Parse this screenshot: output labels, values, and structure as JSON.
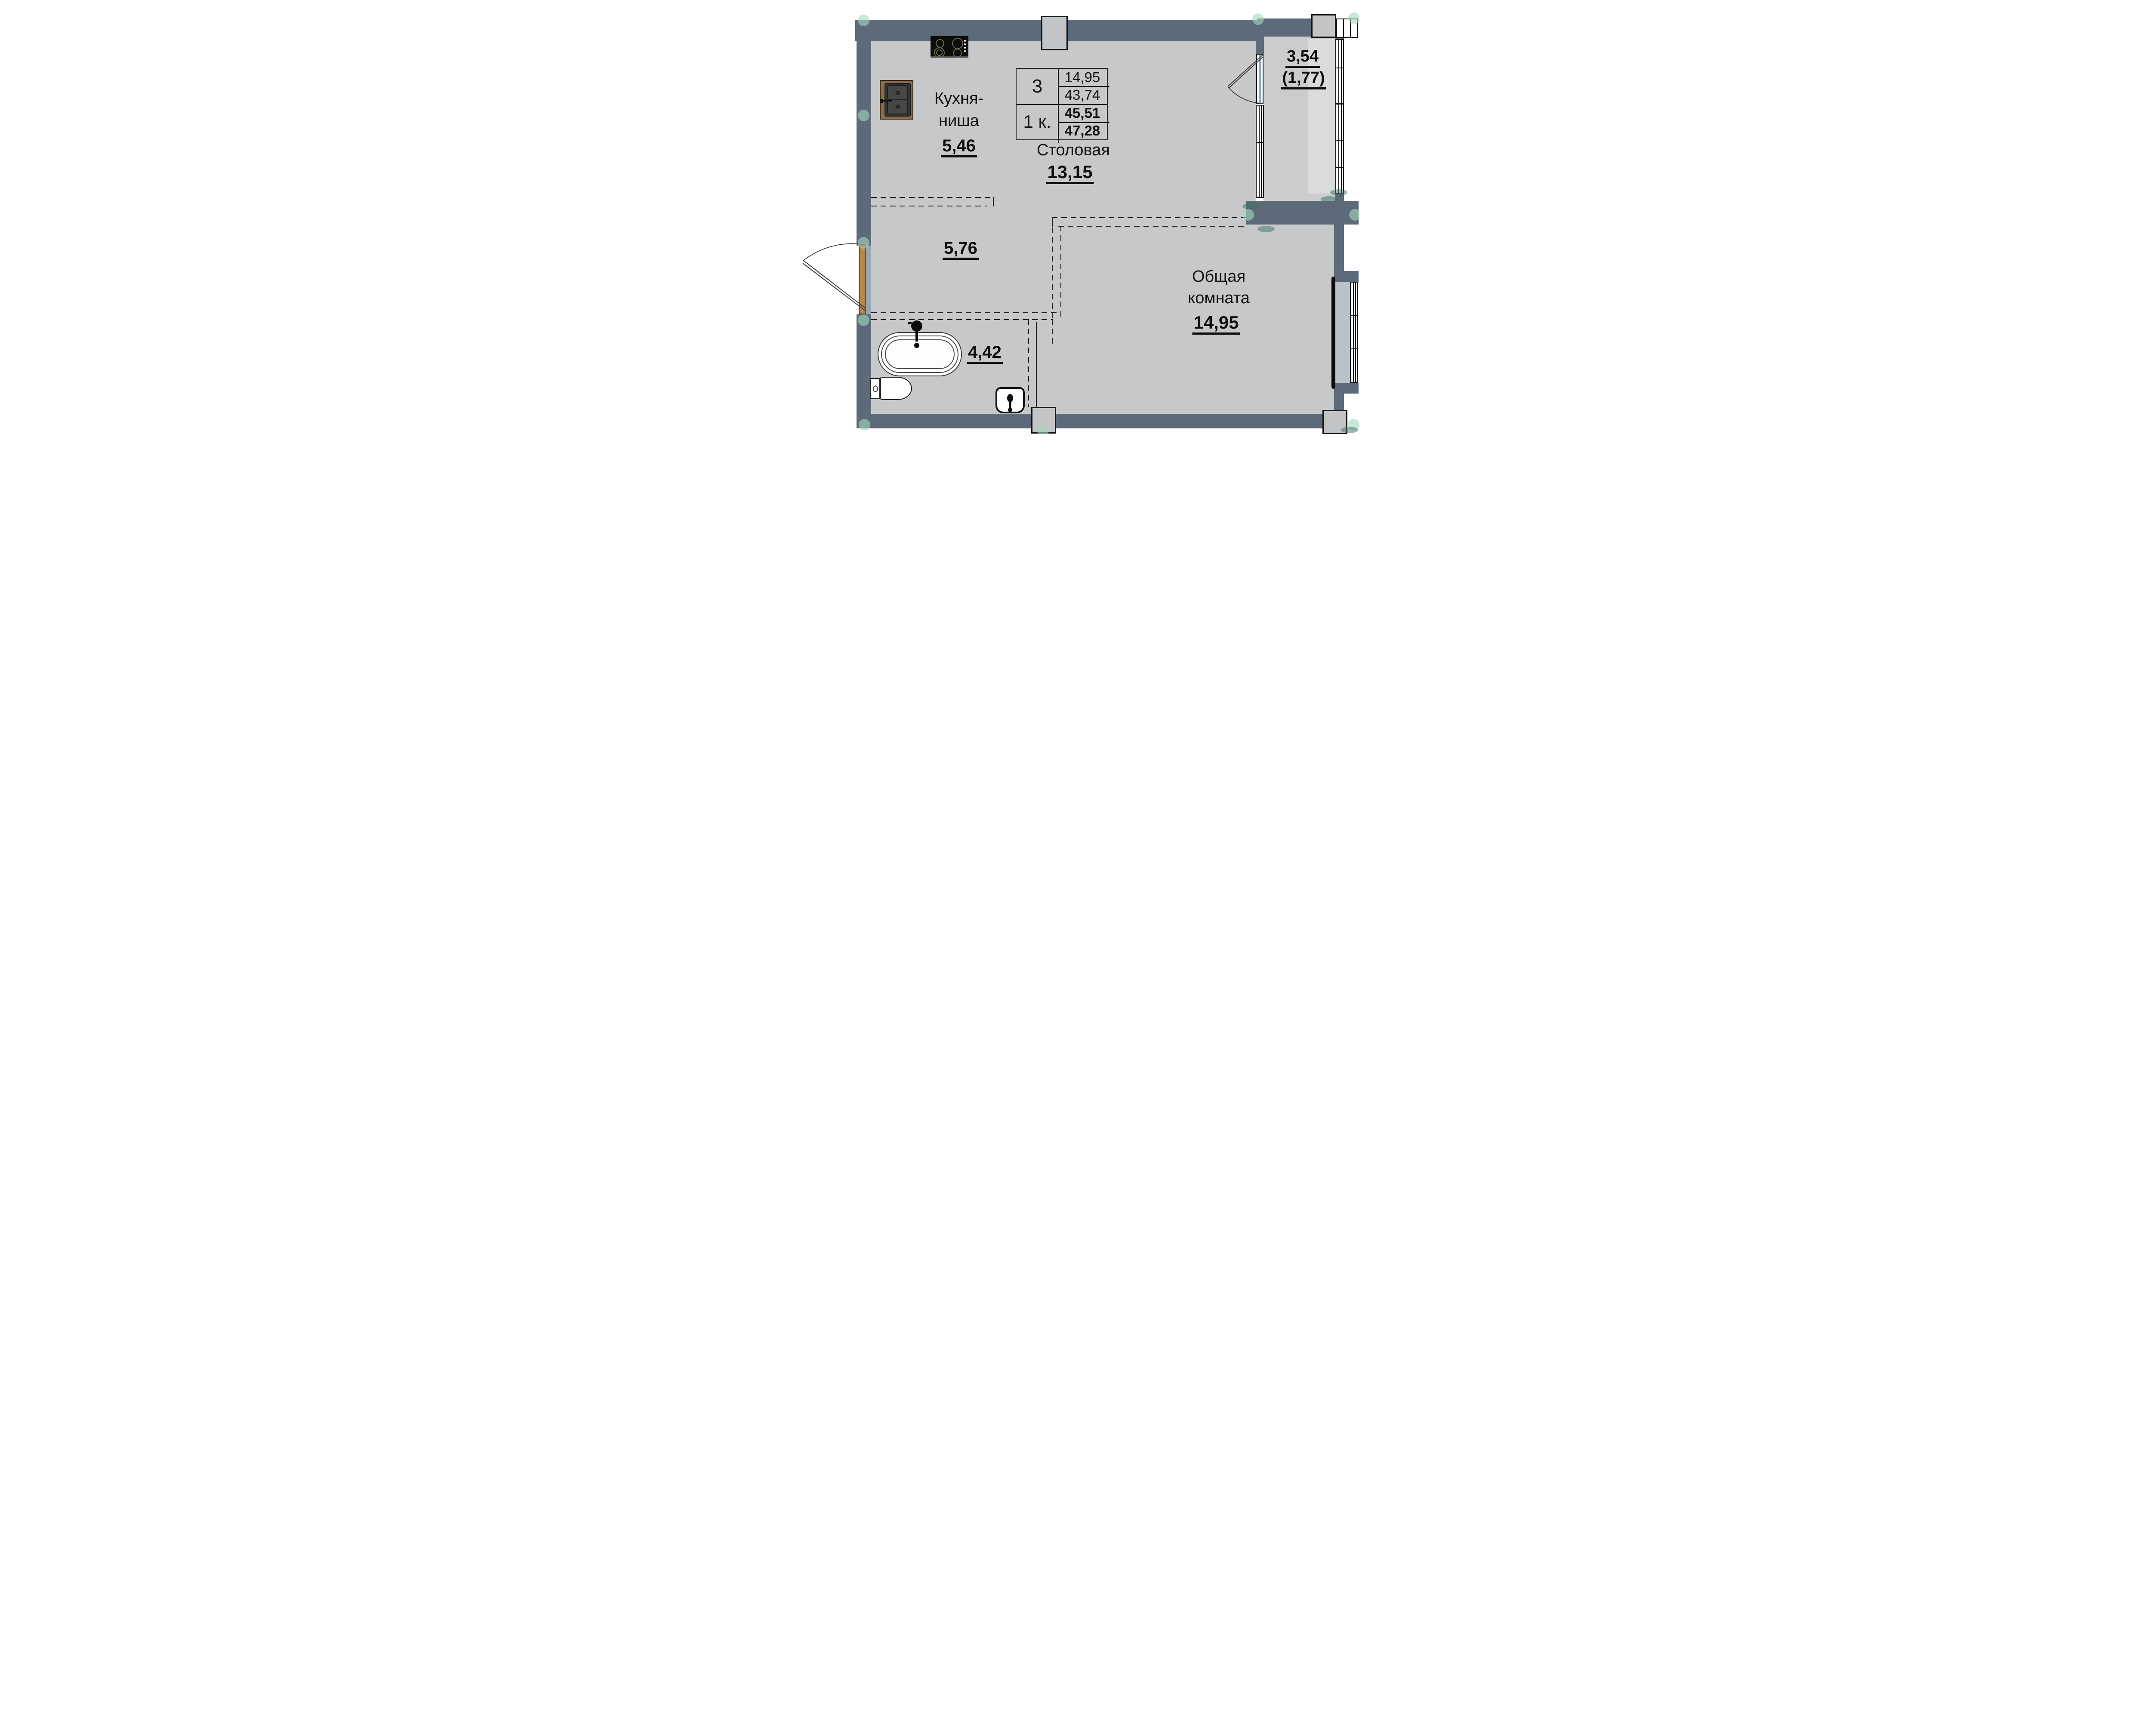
{
  "plan": {
    "stat_table": {
      "rooms_count": "3",
      "unit_type": "1 к.",
      "living_area": "14,95",
      "area_mid": "43,74",
      "area_no_balcony": "45,51",
      "area_total": "47,28"
    },
    "rooms": {
      "kitchen": {
        "label_line1": "Кухня-",
        "label_line2": "ниша",
        "area": "5,46"
      },
      "dining": {
        "label": "Столовая",
        "area": "13,15"
      },
      "living": {
        "label_line1": "Общая",
        "label_line2": "комната",
        "area": "14,95"
      },
      "hall": {
        "area": "5,76"
      },
      "bathroom": {
        "area": "4,42"
      },
      "balcony": {
        "area": "3,54",
        "area_reduced": "(1,77)"
      }
    },
    "colors": {
      "wall": "#5c6a79",
      "floor": "#c7c8c9",
      "balcony_floor": "#caccce",
      "balcony_floor_light": "#d9dbdd",
      "window_sill": "#b9c1c9",
      "door_wood": "#b98749",
      "door_glass": "#86aec5",
      "marker_mint": "#a4d8bd",
      "marker_teal": "#3e7064"
    },
    "icons": [
      "stove-icon",
      "kitchen-sink-icon",
      "bathtub-icon",
      "faucet-icon",
      "toilet-icon",
      "washbasin-icon",
      "radiator-icon",
      "door-swing-icon",
      "window-icon",
      "corner-marker-icon"
    ]
  }
}
